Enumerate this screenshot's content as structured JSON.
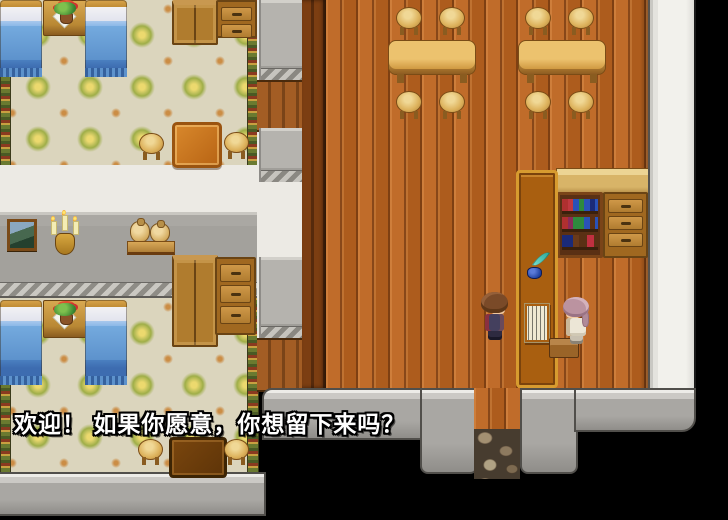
{
  "dialog": {
    "text": "欢迎！ 如果你愿意，你想留下来吗？"
  },
  "scene": {
    "type": "top-down RPG inn interior",
    "regions": {
      "bedroom_top": "wallpapered room with two blue beds, nightstand plant, cabinet and dresser",
      "bedroom_bottom": "wallpapered room with two blue beds, wardrobe, dresser, table and stools",
      "hall_wall": "gray wall with painting, candle sconce and sack shelf",
      "tavern": "wooden-floor dining hall with two long tables and eight stools",
      "reception": "tall counter with quill, ink bottle and guest ledger; bookshelf and drawer cabinet beside",
      "exit": "stone path doorway at bottom center leading outside"
    },
    "characters": [
      {
        "name": "player",
        "description": "brown-haired adventurer facing right toward the counter"
      },
      {
        "name": "innkeeper",
        "description": "mauve-haired innkeeper seated facing left behind the counter"
      }
    ]
  },
  "colors": {
    "outside_black": "#000000",
    "tavern_floor": "#b4601f",
    "tavern_wall_dark": "#6f3911",
    "wallpaper_base": "#dbd5bd",
    "wallpaper_rosette": "#9fae48",
    "gray_wall": "#a3a19c",
    "white_wall": "#f2f1ec",
    "bed_blanket": "#74aade",
    "counter_body": "#a95f10",
    "counter_trim": "#d79b2f",
    "table_wood": "#d9a84e",
    "dialog_text_color": "#ffffff"
  }
}
